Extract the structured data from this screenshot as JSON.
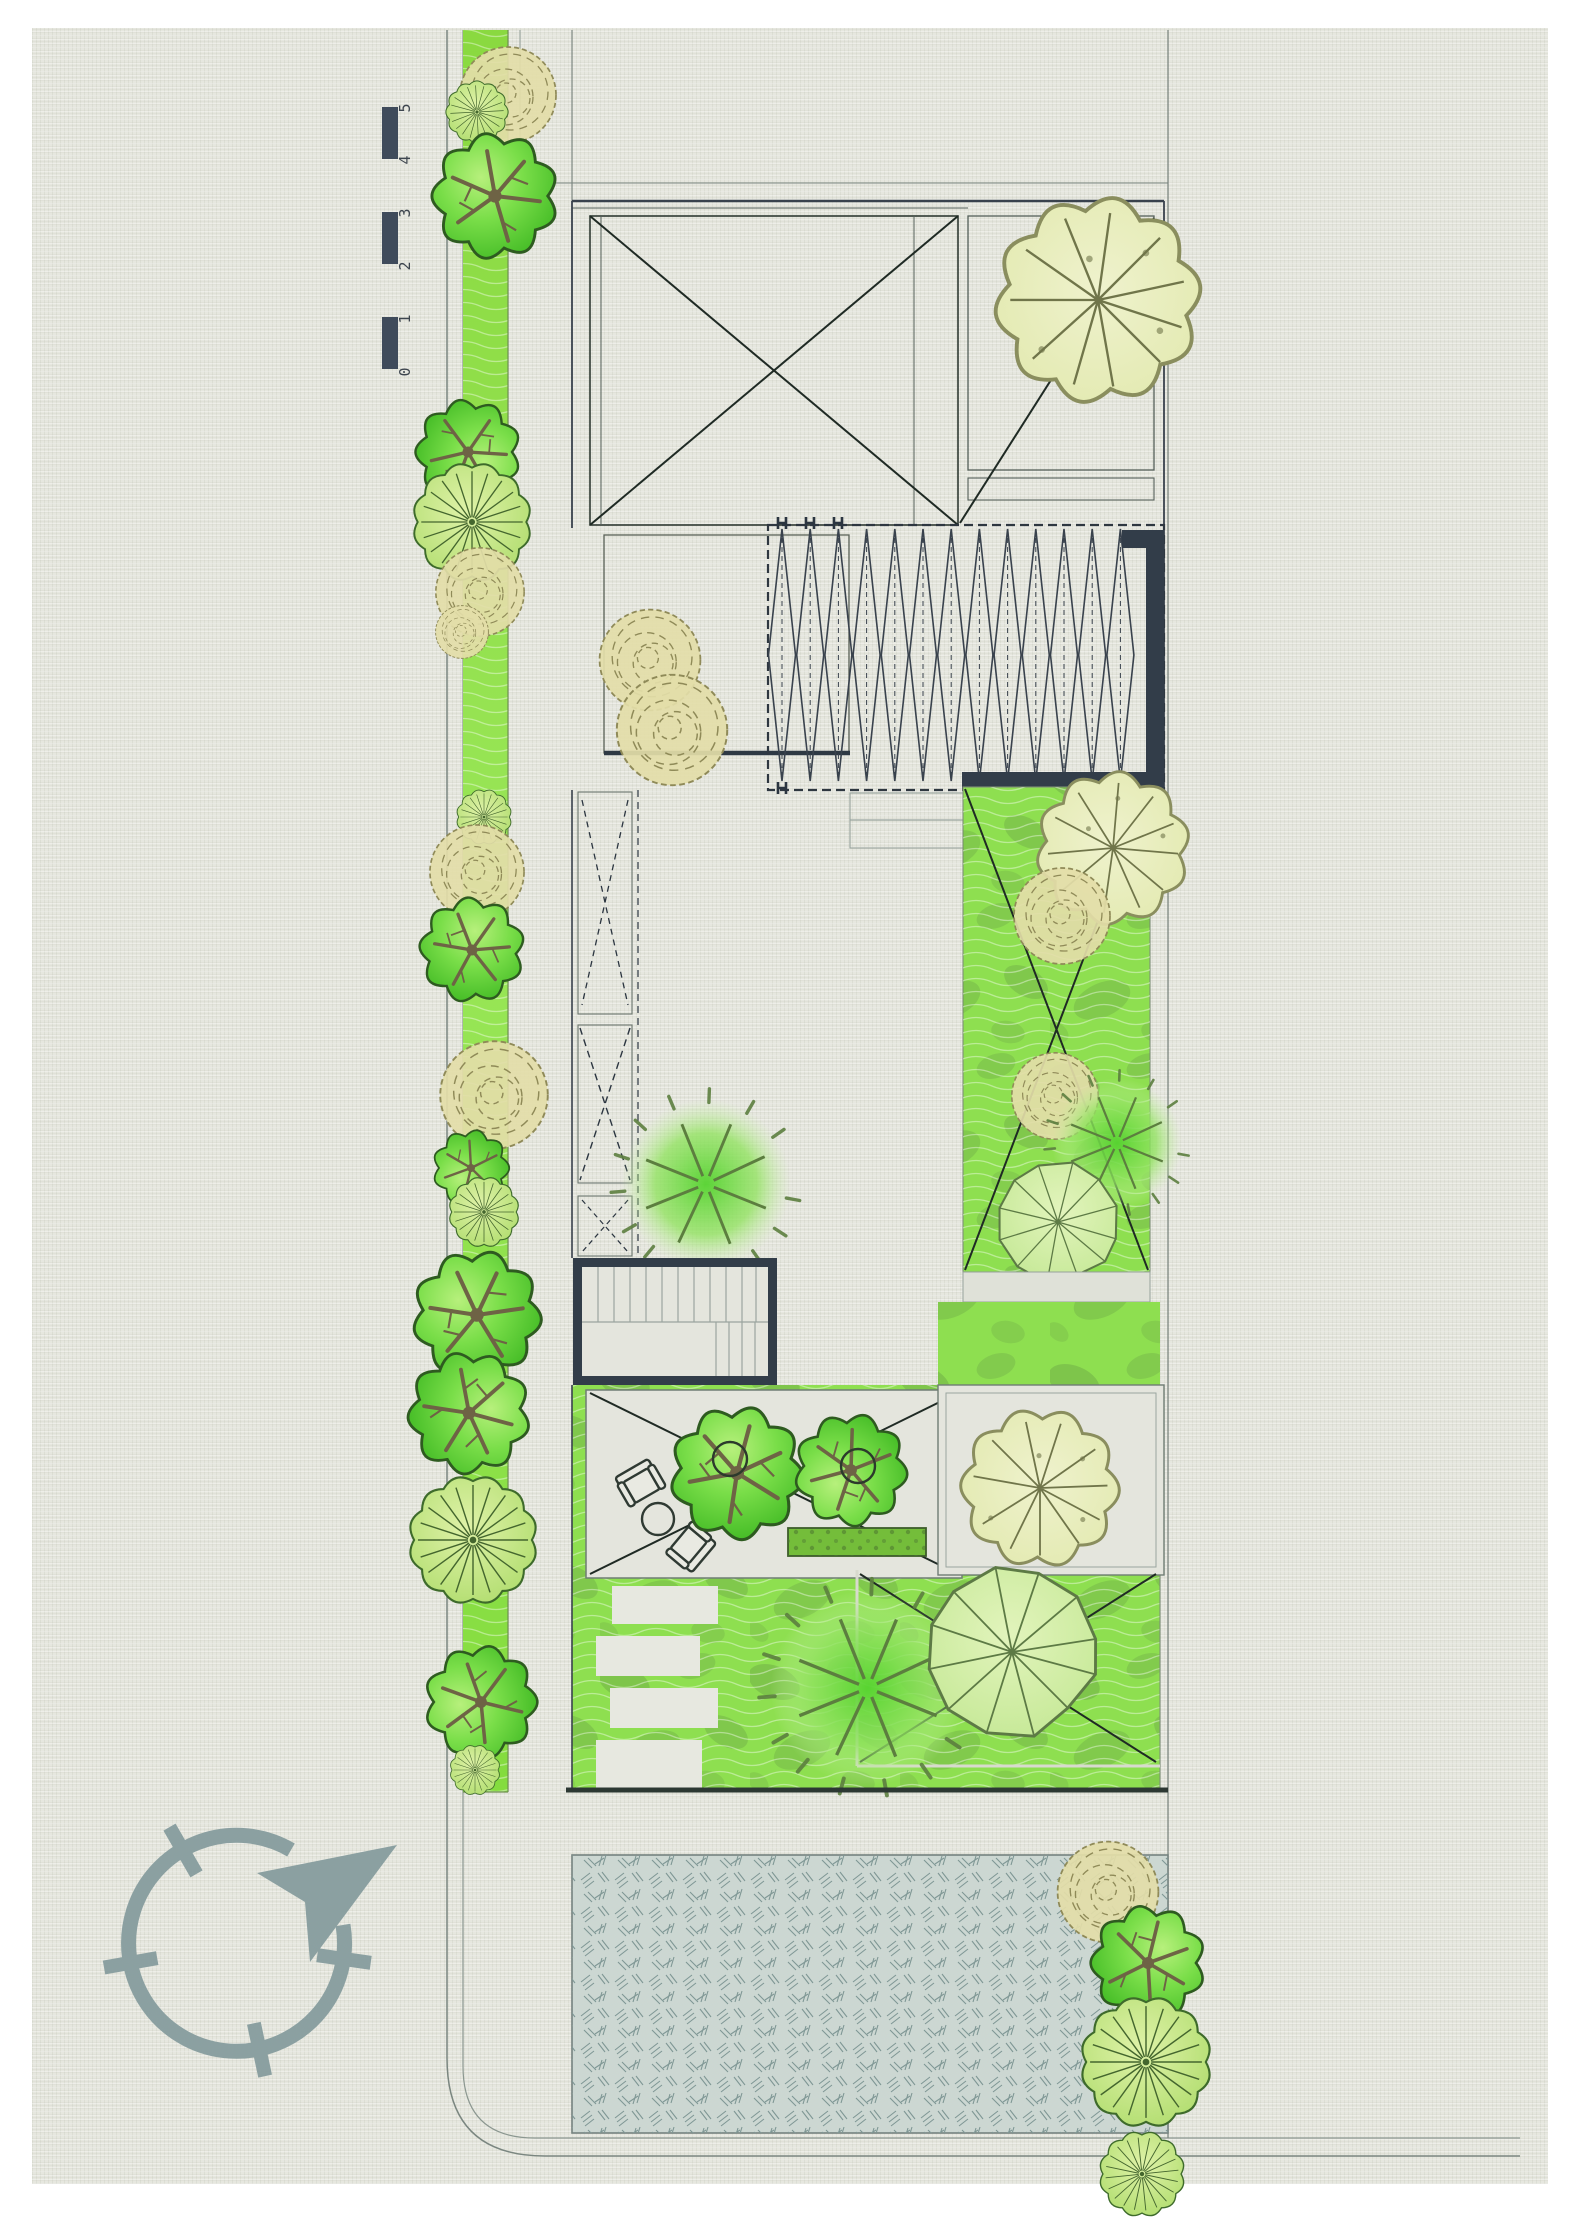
{
  "document": {
    "title": "Landscape site plan",
    "type": "architectural-site-plan"
  },
  "scale_bar": {
    "labels": [
      "0",
      "1",
      "2",
      "3",
      "4",
      "5"
    ]
  },
  "icons": {
    "north_arrow": "compass-north-arrow-icon"
  },
  "compass": {
    "arrow_direction": "north-east"
  },
  "palette": {
    "paper": "#e6e7df",
    "ink": "#39424d",
    "line_gray": "#7a8680",
    "wall_dark": "#323d49",
    "verge_green": "#8ce046",
    "lawn_green": "#8edf50",
    "hedge_green": "#74bd3a",
    "plaza_gray": "#ccd7d2",
    "compass_gray": "#8ba0a1",
    "tree_tan": "#e3dda8",
    "tree_pale": "#e9edbc"
  }
}
